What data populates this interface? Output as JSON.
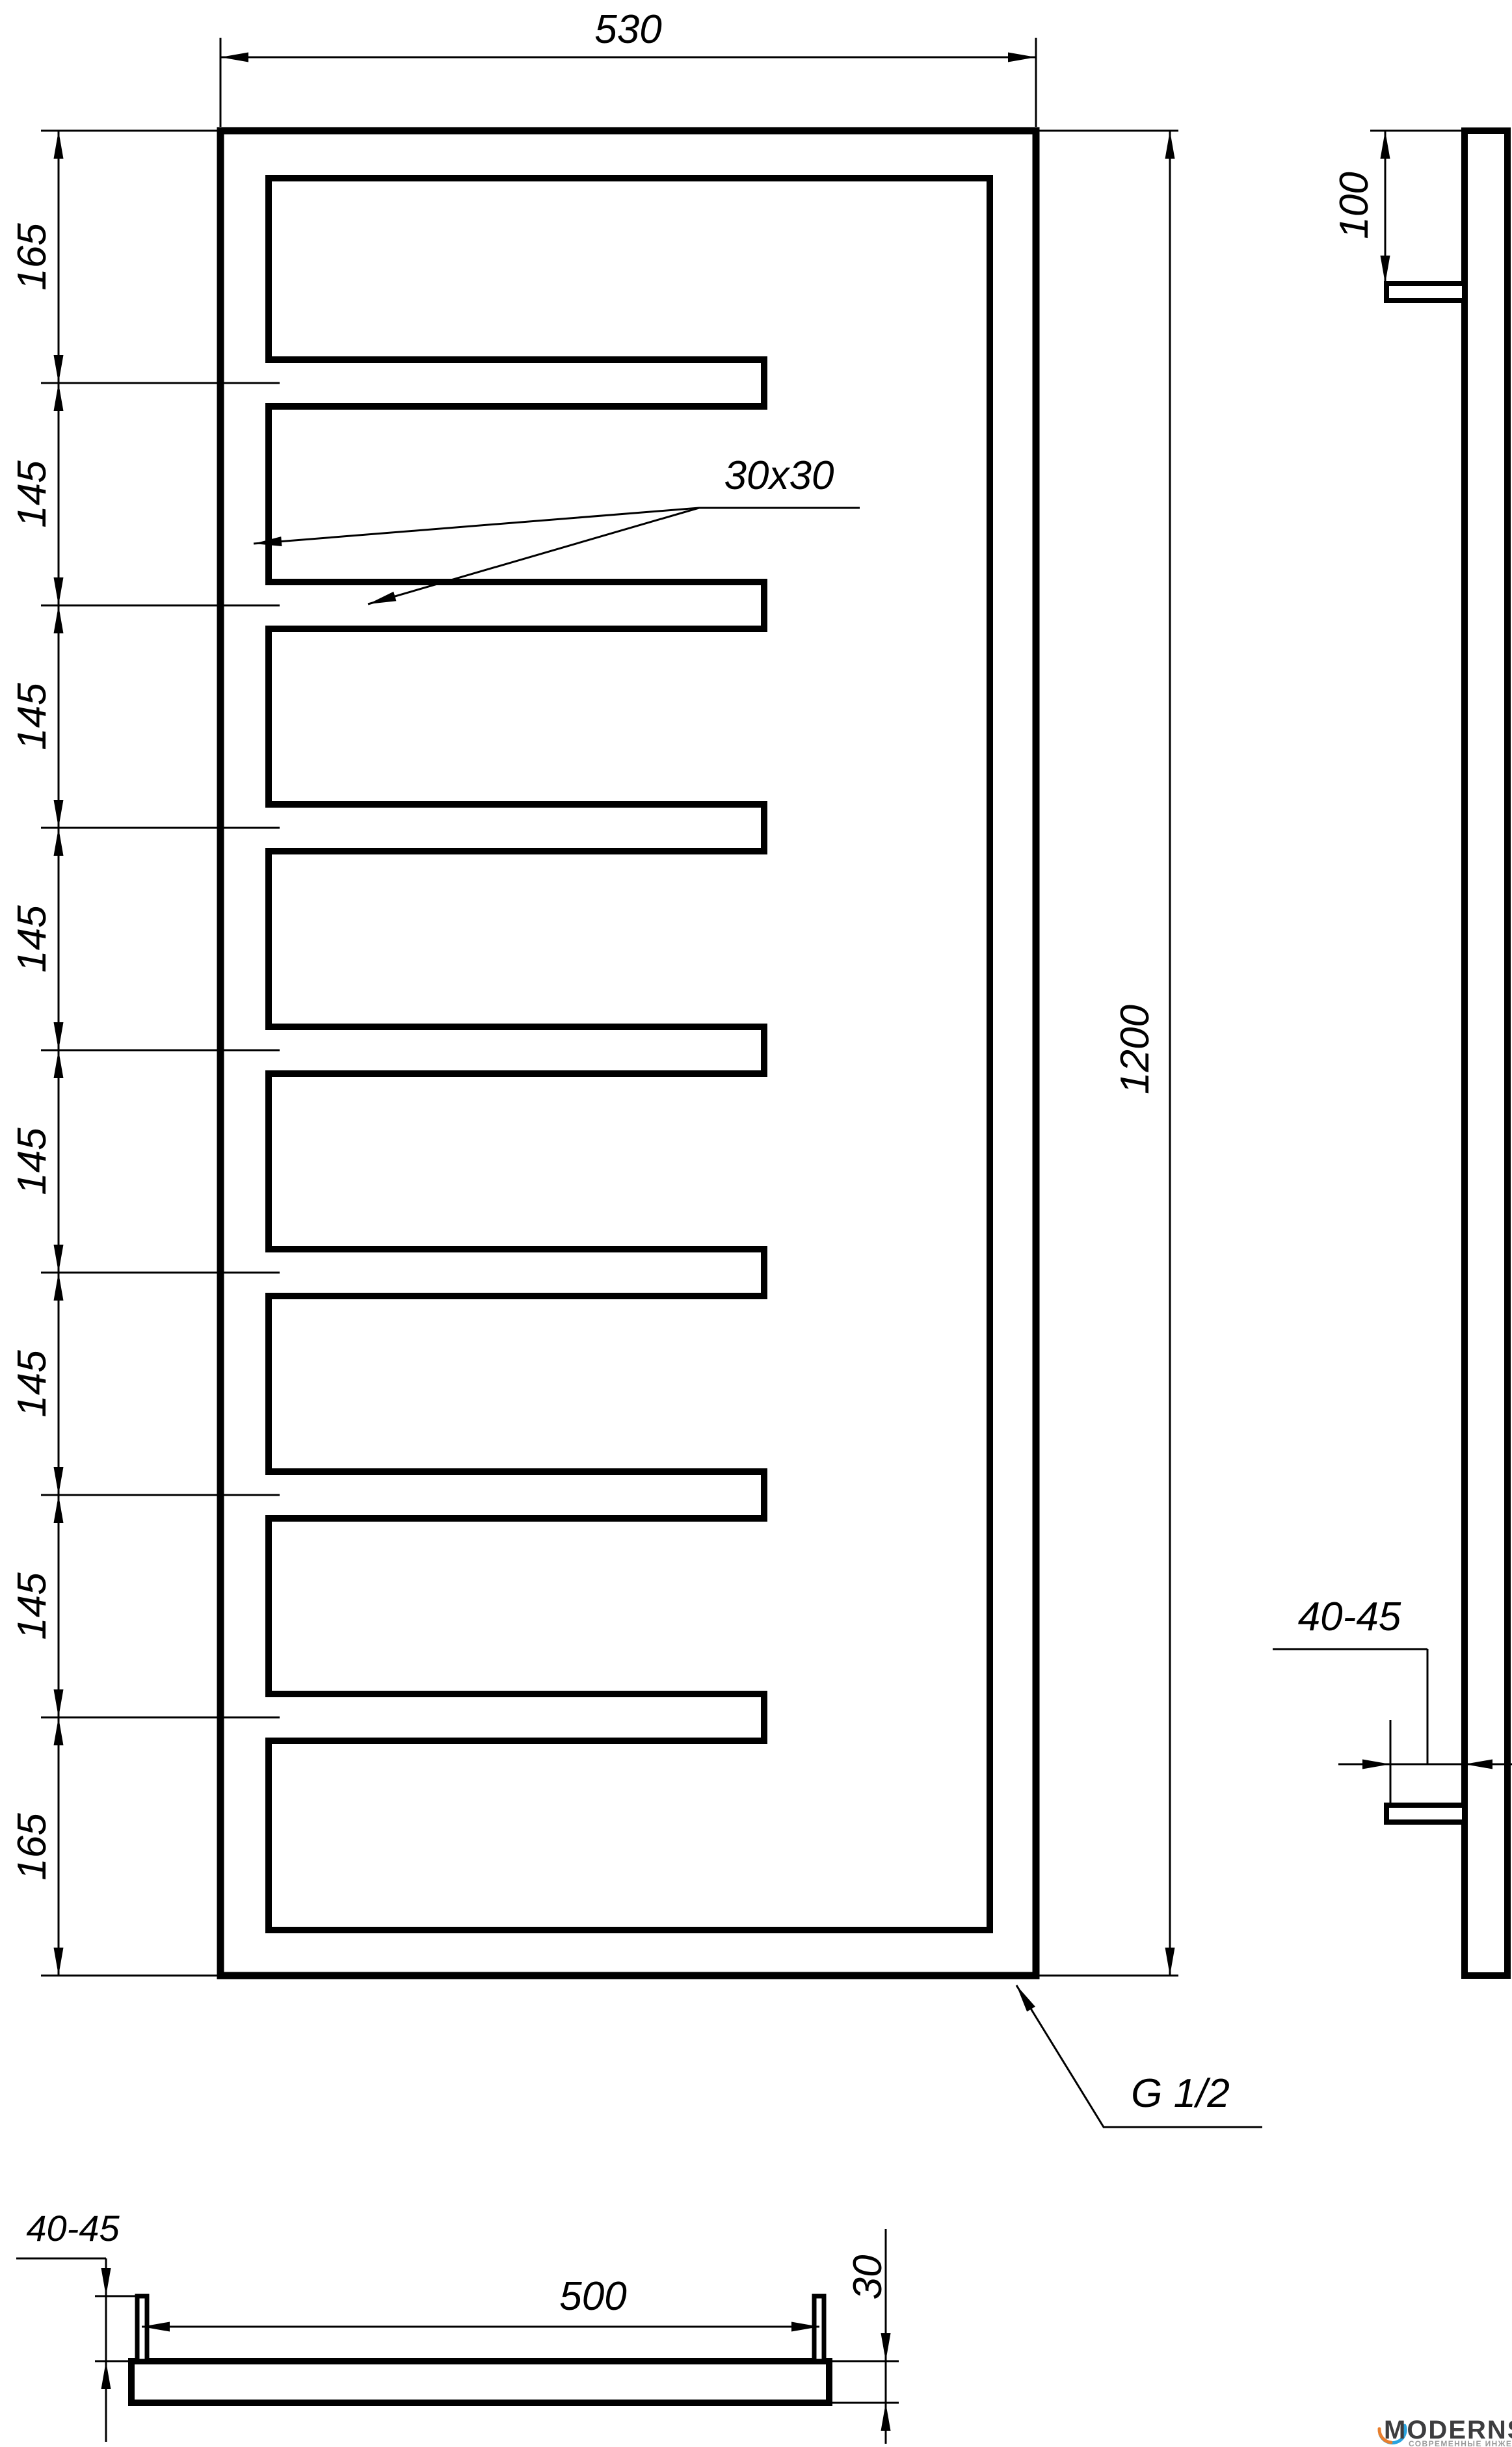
{
  "front_view": {
    "width_dim": "530",
    "height_dim": "1200",
    "segment_dims": [
      "165",
      "145",
      "145",
      "145",
      "145",
      "145",
      "145",
      "165"
    ],
    "tube_size_label": "30x30",
    "thread_label": "G 1/2"
  },
  "side_view": {
    "top_offset_dim": "100",
    "wall_clearance_dim": "40-45"
  },
  "bottom_view": {
    "wall_clearance_dim": "40-45",
    "bracket_spacing_dim": "500",
    "tube_depth_dim": "30"
  },
  "logo": {
    "brand": "MODERNSYS",
    "tagline": "СОВРЕМЕННЫЕ ИНЖЕНЕРНЫЕ СИСТЕМЫ",
    "brand_color": "#3d3d3f",
    "tagline_color": "#9a9a9a",
    "arc_top_color": "#2aa3de",
    "arc_bottom_color": "#e87f2e"
  },
  "colors": {
    "line": "#000000",
    "background": "#ffffff"
  }
}
